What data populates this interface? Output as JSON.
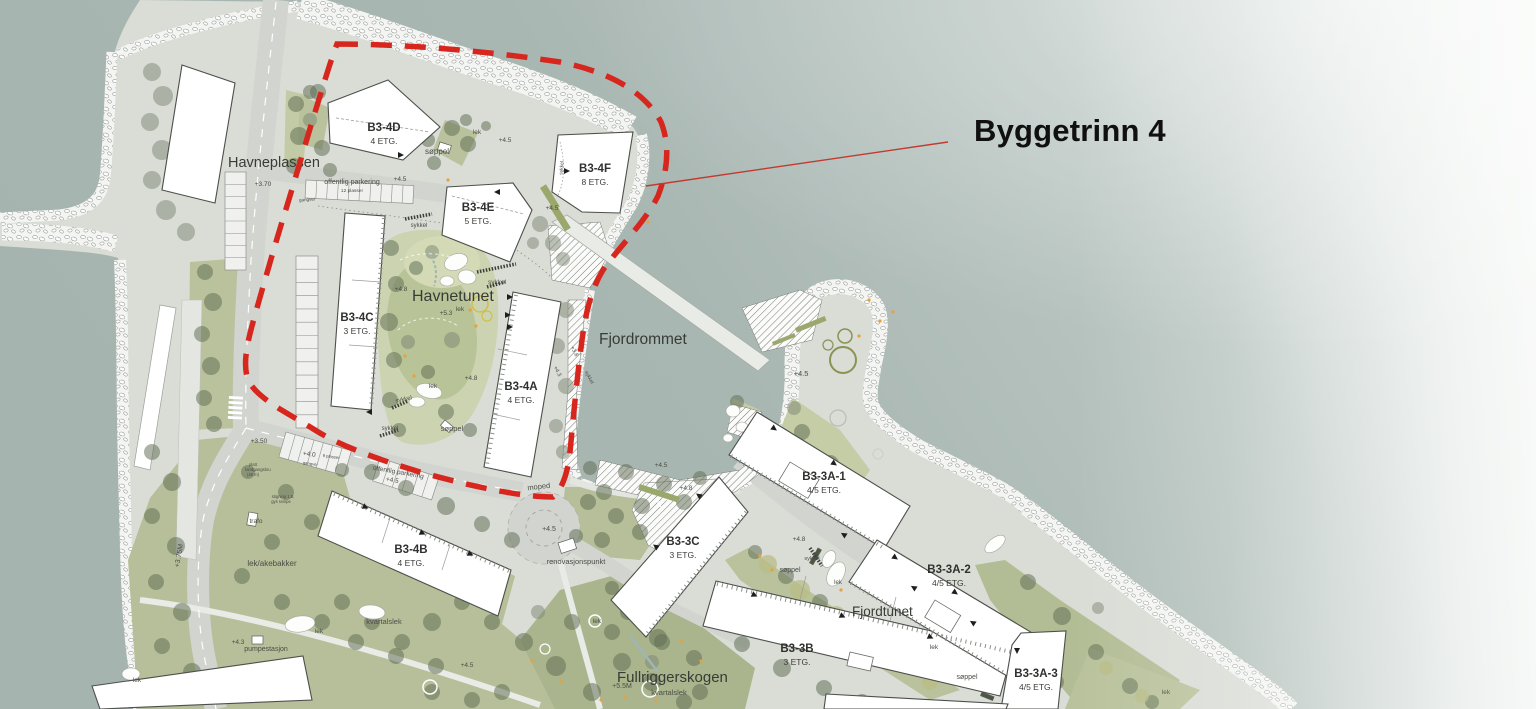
{
  "annotation": {
    "title": "Byggetrinn 4"
  },
  "buildings": [
    {
      "id": "B3-4D",
      "floors": "4 ETG.",
      "lx": 384,
      "ly": 131
    },
    {
      "id": "B3-4E",
      "floors": "5 ETG.",
      "lx": 478,
      "ly": 211
    },
    {
      "id": "B3-4F",
      "floors": "8 ETG.",
      "lx": 595,
      "ly": 172
    },
    {
      "id": "B3-4C",
      "floors": "3 ETG.",
      "lx": 357,
      "ly": 321
    },
    {
      "id": "B3-4A",
      "floors": "4 ETG.",
      "lx": 521,
      "ly": 390
    },
    {
      "id": "B3-4B",
      "floors": "4 ETG.",
      "lx": 411,
      "ly": 553
    },
    {
      "id": "B3-3C",
      "floors": "3 ETG.",
      "lx": 683,
      "ly": 545
    },
    {
      "id": "B3-3B",
      "floors": "3 ETG.",
      "lx": 797,
      "ly": 652
    },
    {
      "id": "B3-3A-1",
      "floors": "4/5 ETG.",
      "lx": 824,
      "ly": 480
    },
    {
      "id": "B3-3A-2",
      "floors": "4/5 ETG.",
      "lx": 949,
      "ly": 573
    },
    {
      "id": "B3-3A-3",
      "floors": "4/5 ETG.",
      "lx": 1036,
      "ly": 677
    }
  ],
  "places": [
    {
      "name": "Havneplassen",
      "x": 228,
      "y": 167,
      "size": 14.5
    },
    {
      "name": "Havnetunet",
      "x": 412,
      "y": 301,
      "size": 16
    },
    {
      "name": "Fjordrommet",
      "x": 599,
      "y": 344,
      "size": 15.5
    },
    {
      "name": "Fjordtunet",
      "x": 852,
      "y": 616,
      "size": 13.5
    },
    {
      "name": "Fullriggerskogen",
      "x": 617,
      "y": 682,
      "size": 15
    }
  ],
  "labels": [
    {
      "t": "offentlig parkering",
      "x": 352,
      "y": 184,
      "s": 7
    },
    {
      "t": "12 plasser",
      "x": 352,
      "y": 192,
      "s": 4.8
    },
    {
      "t": "+4.5",
      "x": 400,
      "y": 181,
      "s": 6.5
    },
    {
      "t": "gangvei",
      "x": 307,
      "y": 201,
      "s": 4.5,
      "r": -4
    },
    {
      "t": "+3.70",
      "x": 263,
      "y": 186,
      "s": 6.5
    },
    {
      "t": "søppel",
      "x": 437,
      "y": 154,
      "s": 8
    },
    {
      "t": "lek",
      "x": 477,
      "y": 134,
      "s": 6.5
    },
    {
      "t": "+4.5",
      "x": 505,
      "y": 142,
      "s": 6.5
    },
    {
      "t": "sykkel",
      "x": 419,
      "y": 227,
      "s": 6
    },
    {
      "t": "+4.5",
      "x": 552,
      "y": 210,
      "s": 6.5
    },
    {
      "t": "sykkel",
      "x": 497,
      "y": 284,
      "s": 6.5
    },
    {
      "t": "+4.8",
      "x": 401,
      "y": 291,
      "s": 6.5
    },
    {
      "t": "+5.3",
      "x": 446,
      "y": 315,
      "s": 6.5
    },
    {
      "t": "lek",
      "x": 460,
      "y": 311,
      "s": 6.5
    },
    {
      "t": "lek",
      "x": 433,
      "y": 388,
      "s": 6.5
    },
    {
      "t": "+4.8",
      "x": 471,
      "y": 380,
      "s": 6.5
    },
    {
      "t": "sykkel",
      "x": 404,
      "y": 401,
      "s": 6,
      "r": -12
    },
    {
      "t": "sykkel",
      "x": 390,
      "y": 430,
      "s": 6
    },
    {
      "t": "søppel",
      "x": 452,
      "y": 431,
      "s": 7.5
    },
    {
      "t": "sykkel",
      "x": 563,
      "y": 168,
      "s": 5,
      "r": -85
    },
    {
      "t": "+3.8",
      "x": 573,
      "y": 352,
      "s": 5.5,
      "r": 62
    },
    {
      "t": "+4.3",
      "x": 556,
      "y": 372,
      "s": 5.5,
      "r": 62
    },
    {
      "t": "sykkel",
      "x": 588,
      "y": 378,
      "s": 5,
      "r": 62
    },
    {
      "t": "moped",
      "x": 539,
      "y": 489,
      "s": 7.5,
      "r": -6
    },
    {
      "t": "+4.5",
      "x": 549,
      "y": 531,
      "s": 7
    },
    {
      "t": "renovasjonspunkt",
      "x": 576,
      "y": 564,
      "s": 7.5
    },
    {
      "t": "offentlig parkering",
      "x": 398,
      "y": 474,
      "s": 6.5,
      "r": 10
    },
    {
      "t": "+4.5",
      "x": 392,
      "y": 482,
      "s": 6.5,
      "r": 10
    },
    {
      "t": "+4.0",
      "x": 309,
      "y": 456,
      "s": 6.5,
      "r": 8
    },
    {
      "t": "9 plasser",
      "x": 331,
      "y": 458,
      "s": 4.2,
      "r": 8
    },
    {
      "t": "gangvei",
      "x": 310,
      "y": 465,
      "s": 4.2,
      "r": 8
    },
    {
      "t": "+3.50",
      "x": 259,
      "y": 443,
      "s": 6.5
    },
    {
      "t": "platt",
      "x": 253,
      "y": 466,
      "s": 4.2
    },
    {
      "t": "landgangsbru",
      "x": 258,
      "y": 471,
      "s": 4.2
    },
    {
      "t": "(46 m)",
      "x": 253,
      "y": 476,
      "s": 4.2
    },
    {
      "t": "stigning 1:8,",
      "x": 283,
      "y": 498,
      "s": 4.2
    },
    {
      "t": "gys rampe",
      "x": 281,
      "y": 503,
      "s": 4.2
    },
    {
      "t": "trafo",
      "x": 256,
      "y": 523,
      "s": 6.5
    },
    {
      "t": "+3.75M",
      "x": 181,
      "y": 556,
      "s": 7,
      "r": -80
    },
    {
      "t": "lek/akebakker",
      "x": 272,
      "y": 566,
      "s": 8
    },
    {
      "t": "lek",
      "x": 137,
      "y": 682,
      "s": 6.5
    },
    {
      "t": "kvartalslek",
      "x": 384,
      "y": 624,
      "s": 7.5
    },
    {
      "t": "lek",
      "x": 319,
      "y": 633,
      "s": 6.5
    },
    {
      "t": "+4.3",
      "x": 238,
      "y": 644,
      "s": 6.5
    },
    {
      "t": "pumpestasjon",
      "x": 266,
      "y": 651,
      "s": 7
    },
    {
      "t": "+4.5",
      "x": 467,
      "y": 667,
      "s": 6.5
    },
    {
      "t": "lek",
      "x": 597,
      "y": 623,
      "s": 6.5
    },
    {
      "t": "+5.5M",
      "x": 622,
      "y": 688,
      "s": 7
    },
    {
      "t": "kvartalslek",
      "x": 669,
      "y": 695,
      "s": 7.5
    },
    {
      "t": "+4.5",
      "x": 661,
      "y": 467,
      "s": 6.5
    },
    {
      "t": "+4.8",
      "x": 686,
      "y": 490,
      "s": 6.5
    },
    {
      "t": "+4.8",
      "x": 799,
      "y": 541,
      "s": 6.5
    },
    {
      "t": "søppel",
      "x": 790,
      "y": 572,
      "s": 7
    },
    {
      "t": "sykkel",
      "x": 812,
      "y": 560,
      "s": 5.5
    },
    {
      "t": "lek",
      "x": 838,
      "y": 584,
      "s": 6
    },
    {
      "t": "lek",
      "x": 934,
      "y": 649,
      "s": 6.5
    },
    {
      "t": "søppel",
      "x": 967,
      "y": 679,
      "s": 7
    },
    {
      "t": "+4.5",
      "x": 801,
      "y": 376,
      "s": 7.5
    },
    {
      "t": "lek",
      "x": 1166,
      "y": 694,
      "s": 6.5
    }
  ],
  "colors": {
    "boundary_red": "#d7261d",
    "leader_red": "#c23a2e",
    "water": "#a9b7b3",
    "land": "#dadcd6",
    "road": "#d2d4cf",
    "green": "#b9c29c",
    "building_fill": "#ffffff",
    "title_text": "#101010"
  }
}
